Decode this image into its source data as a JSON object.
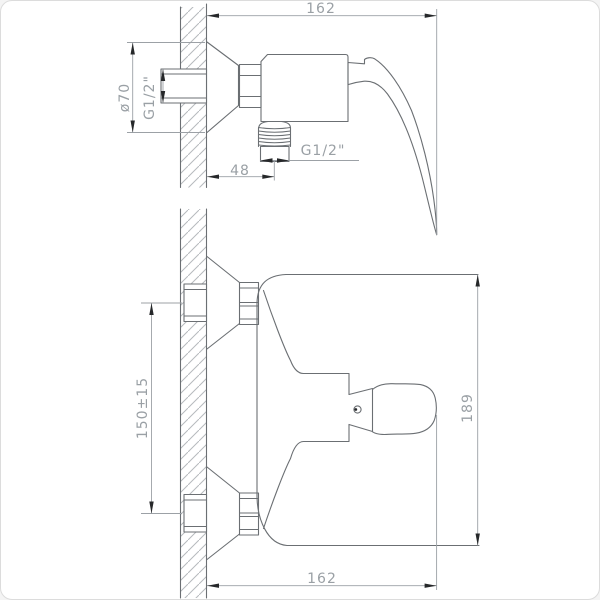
{
  "drawing": {
    "type": "technical-dimension-drawing",
    "subject": "Wall-mounted single-lever shower mixer, side view (top) and plan view (bottom)",
    "colors": {
      "outline": "#6b6f73",
      "dimension": "#9ca1a6",
      "text": "#9aa0a5",
      "hatch": "#b6babd",
      "arrow": "#26282a",
      "canvas_border": "#dcdcdc",
      "background": "#ffffff"
    },
    "side_view": {
      "dimensions": {
        "wall_to_handle_tip": "162",
        "escutcheon_diameter": "ø70",
        "wall_connection_thread": "G1/2\"",
        "shower_outlet_thread": "G1/2\"",
        "wall_to_outlet_axis": "48"
      }
    },
    "plan_view": {
      "dimensions": {
        "inlet_spacing": "150±15",
        "body_overall_length": "189",
        "wall_to_handle_tip": "162"
      }
    }
  }
}
